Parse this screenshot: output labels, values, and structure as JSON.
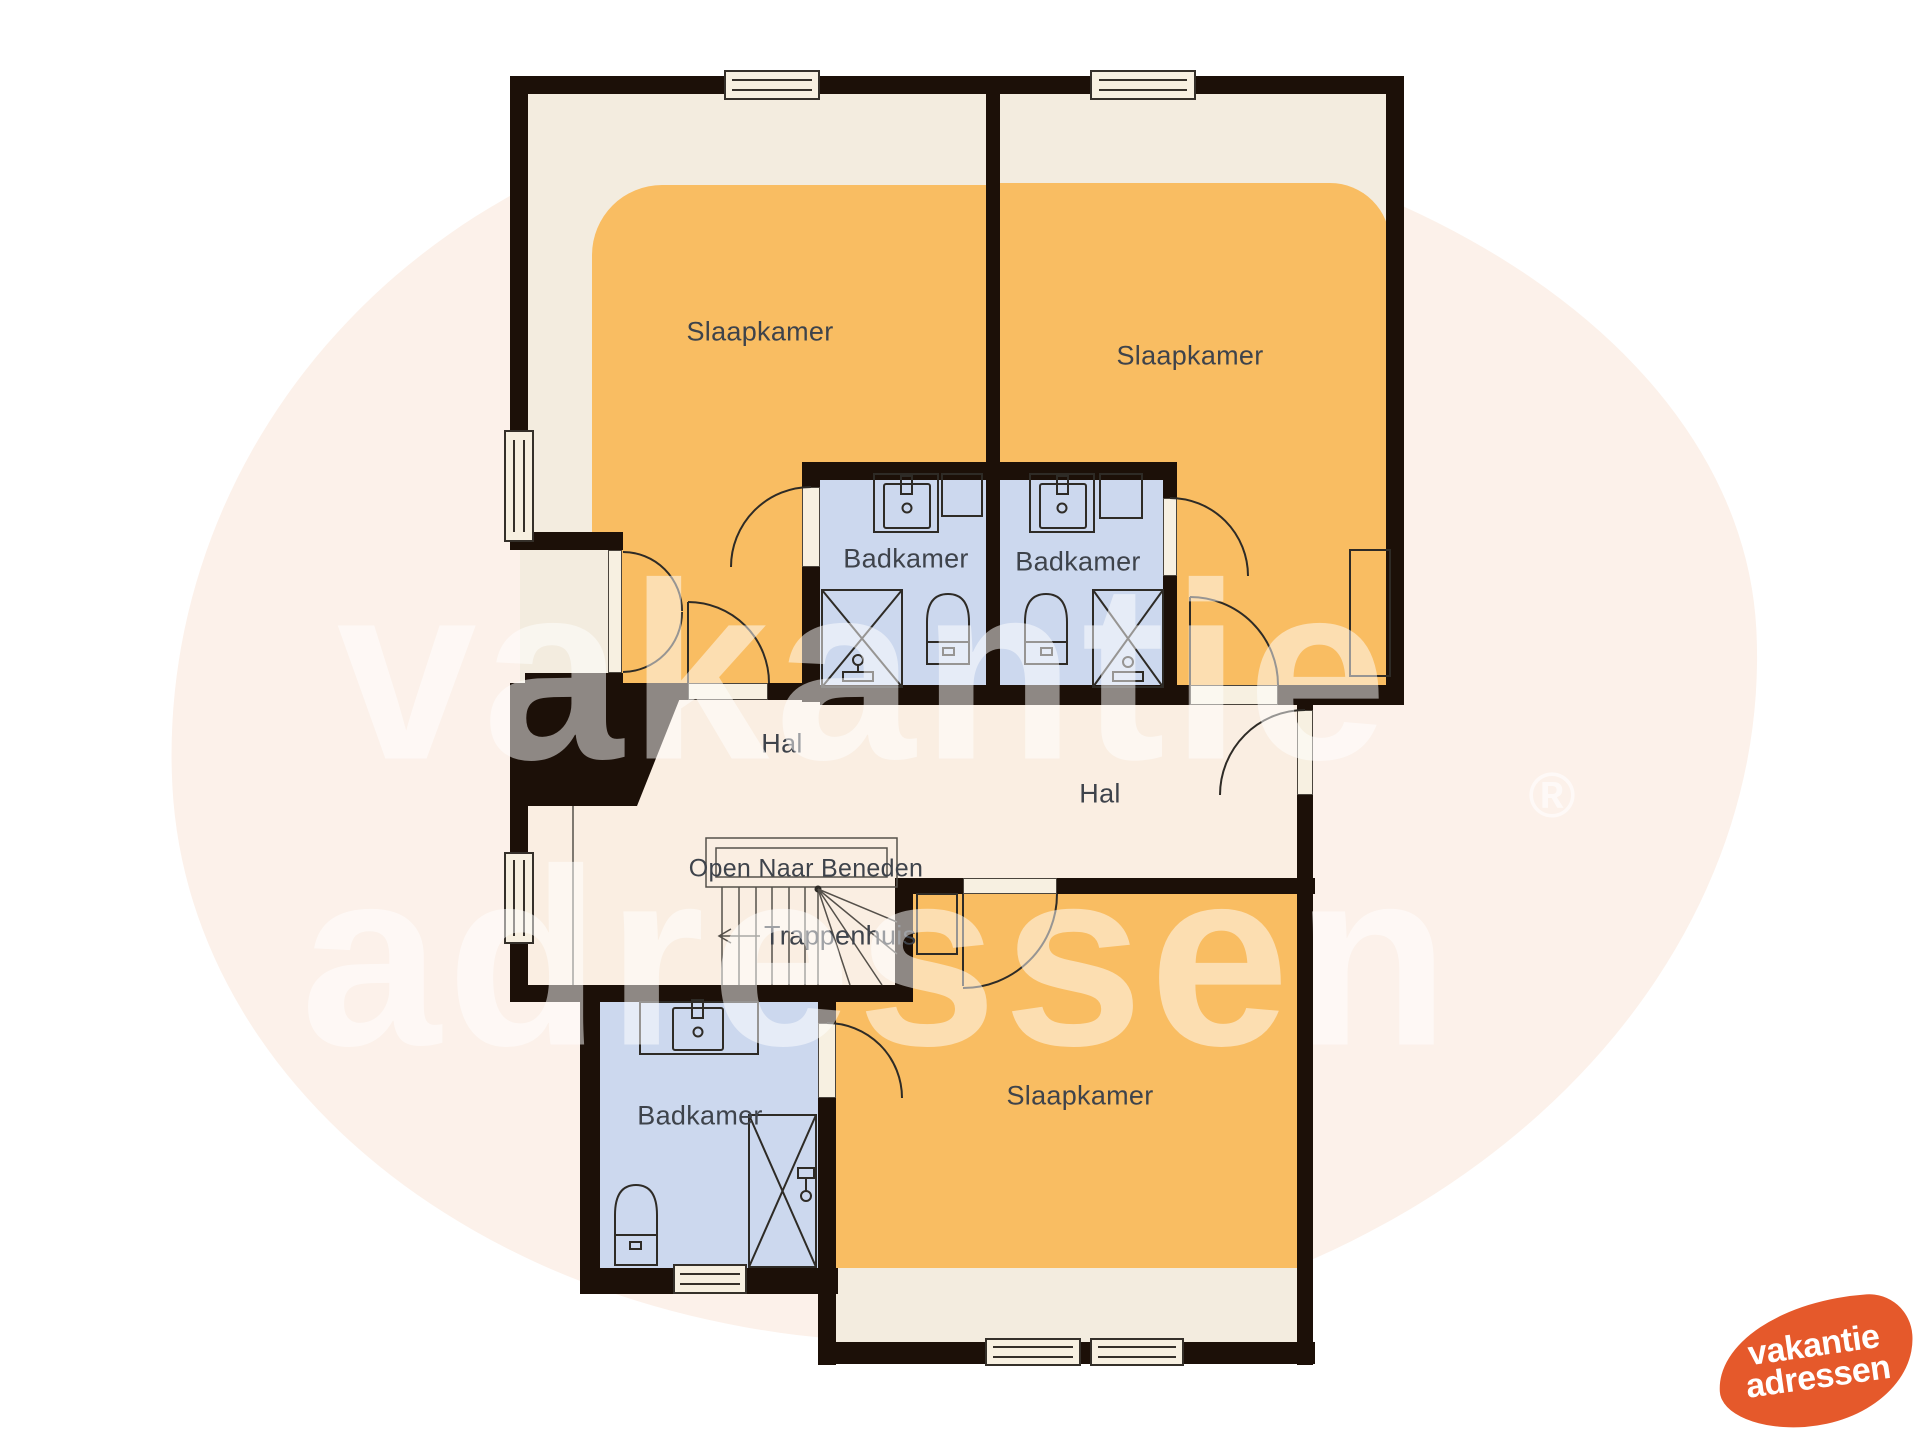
{
  "plan": {
    "rooms": {
      "bedroom_top_left": {
        "label": "Slaapkamer"
      },
      "bedroom_top_right": {
        "label": "Slaapkamer"
      },
      "bedroom_bottom": {
        "label": "Slaapkamer"
      },
      "bathroom_top_left": {
        "label": "Badkamer"
      },
      "bathroom_top_right": {
        "label": "Badkamer"
      },
      "bathroom_bottom": {
        "label": "Badkamer"
      },
      "hall_left": {
        "label": "Hal"
      },
      "hall_right": {
        "label": "Hal"
      }
    },
    "stairs": {
      "void_label": "Open Naar Beneden",
      "label": "Trappenhuis"
    },
    "icons": [
      "sink-icon",
      "toilet-icon",
      "shower-icon",
      "left-arrow-icon",
      "window",
      "door-swing-arc"
    ],
    "colors": {
      "outside": "#ffffff",
      "wall": "#1c1008",
      "bedroom_base": "#f3ecdf",
      "bedroom_accent": "#f9bd62",
      "bathroom_floor": "#ccd8ee",
      "hall_floor": "#faeee2",
      "opening": "#f7f0e1",
      "line": "#2e2b26",
      "label_text": "#3e434b",
      "logo_orange": "#e5592b",
      "watermark_tint": "#fcf1ea"
    }
  },
  "watermark": {
    "line1": "vakantie",
    "line2": "adressen",
    "registered": "®"
  },
  "logo": {
    "line1": "vakantie",
    "line2": "adressen"
  }
}
